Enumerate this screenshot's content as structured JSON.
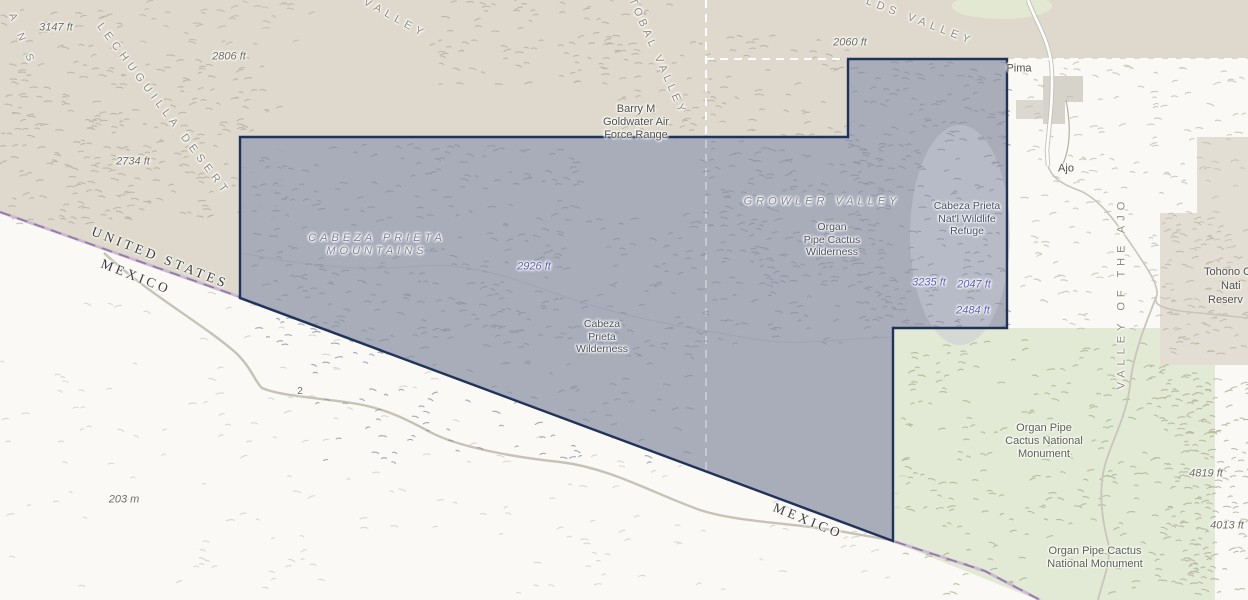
{
  "colors": {
    "land_tan": "#ded9cc",
    "mexico_base": "#faf9f5",
    "monument_green": "#e2e9d5",
    "refuge_fill": "#9da4b6",
    "refuge_outline": "#1e3357",
    "border_purple": "#9077a3",
    "county_line": "#ffffff"
  },
  "labels": {
    "partial_range": "A N S",
    "lechuguilla_desert": "LECHUGUILLA DESERT",
    "valley_nw": "VALLEY",
    "san_cristobal_valley": "TOBAL VALLEY",
    "childs_valley": "LDS VALLEY",
    "elev_3147": "3147 ft",
    "elev_2806": "2806 ft",
    "elev_2734": "2734 ft",
    "elev_2060": "2060 ft",
    "elev_2926": "2926 ft",
    "elev_3235": "3235 ft",
    "elev_2047": "2047 ft",
    "elev_2484": "2484 ft",
    "elev_4819": "4819 ft",
    "elev_4013": "4013 ft",
    "elev_203m": "203 m",
    "barry_goldwater": [
      "Barry M",
      "Goldwater Air",
      "Force Range"
    ],
    "pima_county": "Pima",
    "ajo": "Ajo",
    "cabeza_prieta_mountains": [
      "CABEZA PRIETA",
      "MOUNTAINS"
    ],
    "growler_valley": "GROWLER VALLEY",
    "organ_pipe_wilderness": [
      "Organ",
      "Pipe Cactus",
      "Wilderness"
    ],
    "cabeza_prieta_refuge": [
      "Cabeza Prieta",
      "Nat'l Wildlife",
      "Refuge"
    ],
    "cabeza_prieta_wilderness": [
      "Cabeza",
      "Prieta",
      "Wilderness"
    ],
    "united_states": "UNITED STATES",
    "mexico_west": "MEXICO",
    "mexico_south": "MEXICO",
    "valley_of_the_ajo": "VALLEY OF THE AJO",
    "tohono": [
      "Tohono O",
      "Nati",
      "Reserv"
    ],
    "organ_pipe_monument_north": [
      "Organ Pipe",
      "Cactus National",
      "Monument"
    ],
    "organ_pipe_monument_south": [
      "Organ Pipe Cactus",
      "National Monument"
    ],
    "route_2": "2"
  }
}
